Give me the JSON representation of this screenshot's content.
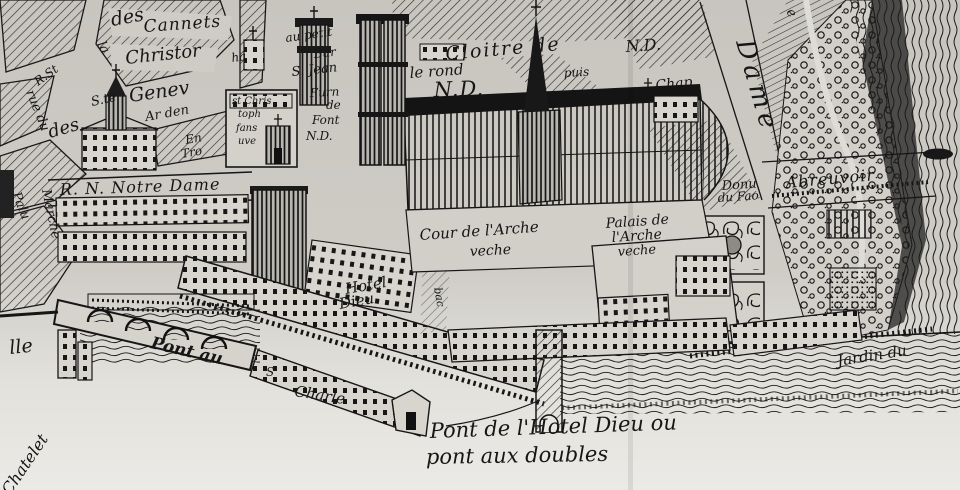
{
  "map": {
    "kind": "engraved city map (Île de la Cité, Paris)",
    "palette": {
      "ink": "#161616",
      "paper": "#cfccc6",
      "paper_light": "#e9e8e4",
      "water_dark": "#1b1b1b"
    },
    "labels": {
      "la": "la",
      "des_top": "des",
      "cannets": "Cannets",
      "christor": "Christor",
      "r_st": "R.St",
      "ha": "ha",
      "ste": "S.te",
      "genev": "Genev",
      "arden": "Ar den",
      "des_left": "des",
      "en": "En",
      "tro": "Tro",
      "st_chris": "st Chris",
      "toph": "toph",
      "fans": "fans",
      "uve": "uve",
      "rue_du": "rue du",
      "marche": "Marche",
      "palu": "Palu",
      "au_petit": "au petit",
      "bur": "Bur",
      "s_jean": "S. Jean",
      "furn": "Furn",
      "de": "de",
      "font": "Font",
      "nd_font": "N.D.",
      "cloitre": "Cloitre de",
      "nd_cloitre": "N.D.",
      "le_rond": "le rond",
      "nd_big": "N.D.",
      "puis": "puis",
      "chap": "Chap",
      "e_frag": "e",
      "dame": "Dame",
      "rnnd": "R. N. Notre Dame",
      "cour": "Cour de l'Arche",
      "veche1": "veche",
      "palais": "Palais de",
      "larche": "l'Arche",
      "veche2": "veche",
      "hotel": "Hotel",
      "dieu": "Dieu",
      "donu": "Donu",
      "du_fao": "du Fao",
      "abreuvoir": "Abreuvoir",
      "jardin": "Jardin du",
      "pont_au": "Pont au",
      "s_charles": "S",
      "charle": "Charle",
      "caption1": "Pont de l'Hotel Dieu ou",
      "caption2": "pont aux doubles",
      "chatelet": "Chatelet",
      "lle": "lle",
      "bac": "bac"
    }
  }
}
